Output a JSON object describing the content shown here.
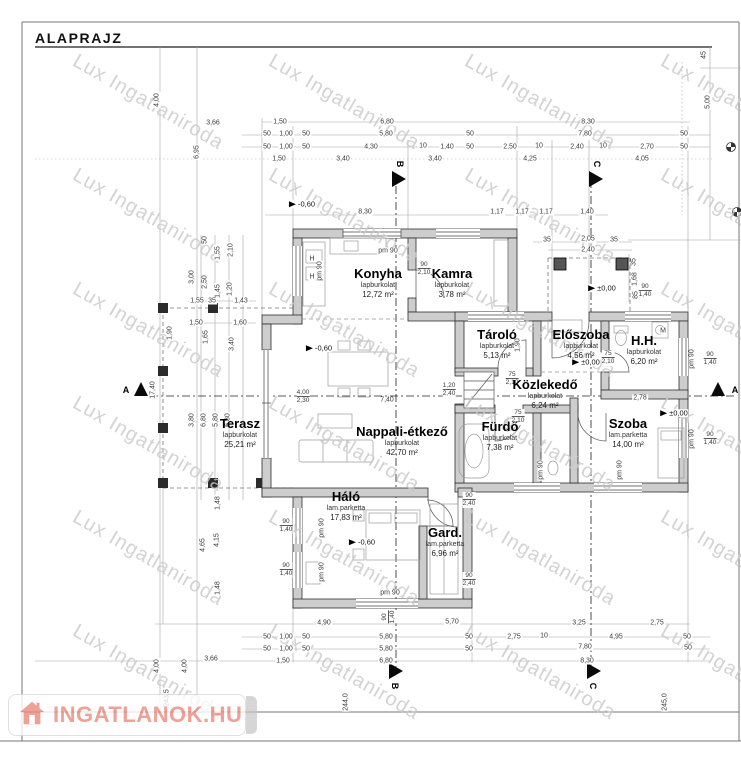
{
  "title": "ALAPRAJZ",
  "watermark": {
    "text": "Lux Ingatlaniroda"
  },
  "logo": {
    "text": "INGATLANOK.HU"
  },
  "colors": {
    "logo_accent": "#ec8a7e",
    "wall_fill": "#cdcdcd",
    "watermark": "#c9c9c9"
  },
  "rooms": [
    {
      "name": "Konyha",
      "floor": "lapburkolat",
      "area": "12,72 m²",
      "x": 378,
      "y": 283
    },
    {
      "name": "Kamra",
      "floor": "lapburkolat",
      "area": "3,78 m²",
      "x": 452,
      "y": 283
    },
    {
      "name": "Tároló",
      "floor": "lapburkolat",
      "area": "5,13 m²",
      "x": 497,
      "y": 344
    },
    {
      "name": "Előszoba",
      "floor": "lapburkolat",
      "area": "4,56 m²",
      "x": 581,
      "y": 344
    },
    {
      "name": "H.H.",
      "floor": "lapburkolat",
      "area": "6,20 m²",
      "x": 644,
      "y": 350
    },
    {
      "name": "Közlekedő",
      "floor": "lapburkolat",
      "area": "6,24 m²",
      "x": 545,
      "y": 394
    },
    {
      "name": "Fürdő",
      "floor": "lapburkolat",
      "area": "7,38 m²",
      "x": 500,
      "y": 436
    },
    {
      "name": "Szoba",
      "floor": "lam.parketta",
      "area": "14,00 m²",
      "x": 628,
      "y": 433
    },
    {
      "name": "Terasz",
      "floor": "lapburkolat",
      "area": "25,21 m²",
      "x": 240,
      "y": 433
    },
    {
      "name": "Nappali-étkező",
      "floor": "lapburkolat",
      "area": "42,70 m²",
      "x": 402,
      "y": 441
    },
    {
      "name": "Háló",
      "floor": "lam.parketta",
      "area": "17,83 m²",
      "x": 346,
      "y": 506
    },
    {
      "name": "Gard.",
      "floor": "lam.parketta",
      "area": "6,96 m²",
      "x": 445,
      "y": 542
    }
  ],
  "levels": [
    {
      "t": "-0,60",
      "x": 302,
      "y": 204
    },
    {
      "t": "-0,60",
      "x": 319,
      "y": 348
    },
    {
      "t": "-0,60",
      "x": 362,
      "y": 542
    },
    {
      "t": "±0,00",
      "x": 602,
      "y": 288
    },
    {
      "t": "±0,00",
      "x": 586,
      "y": 362
    },
    {
      "t": "±0,00",
      "x": 674,
      "y": 413
    }
  ],
  "section_letters": [
    {
      "t": "B",
      "x": 400,
      "y": 164,
      "r": 1
    },
    {
      "t": "C",
      "x": 597,
      "y": 164,
      "r": 1
    },
    {
      "t": "A",
      "x": 126,
      "y": 390
    },
    {
      "t": "A",
      "x": 735,
      "y": 390
    },
    {
      "t": "B",
      "x": 395,
      "y": 686,
      "r": 1
    },
    {
      "t": "C",
      "x": 593,
      "y": 686,
      "r": 1
    }
  ],
  "fractions": [
    {
      "a": "90",
      "b": "2,10",
      "x": 424,
      "y": 269
    },
    {
      "a": "75",
      "b": "2,10",
      "x": 512,
      "y": 379
    },
    {
      "a": "75",
      "b": "2,10",
      "x": 608,
      "y": 358
    },
    {
      "a": "75",
      "b": "2,10",
      "x": 518,
      "y": 417
    },
    {
      "a": "1,20",
      "b": "2,40",
      "x": 449,
      "y": 390
    },
    {
      "a": "4,00",
      "b": "2,30",
      "x": 303,
      "y": 397
    },
    {
      "a": "90",
      "b": "1,40",
      "x": 286,
      "y": 526
    },
    {
      "a": "90",
      "b": "1,40",
      "x": 286,
      "y": 570
    },
    {
      "a": "90",
      "b": "1,40",
      "x": 710,
      "y": 359
    },
    {
      "a": "90",
      "b": "1,40",
      "x": 710,
      "y": 439
    },
    {
      "a": "90",
      "b": "1,40",
      "x": 645,
      "y": 291
    },
    {
      "a": "90",
      "b": "2,40",
      "x": 469,
      "y": 500
    },
    {
      "a": "90",
      "b": "2,40",
      "x": 469,
      "y": 580
    },
    {
      "a": "90",
      "b": "1,40",
      "x": 389,
      "y": 617,
      "r": 1
    }
  ],
  "dims": [
    {
      "t": "1,50",
      "x": 280,
      "y": 122
    },
    {
      "t": "6,80",
      "x": 387,
      "y": 122
    },
    {
      "t": "8,30",
      "x": 588,
      "y": 122
    },
    {
      "t": "50",
      "x": 267,
      "y": 134
    },
    {
      "t": "1,00",
      "x": 286,
      "y": 134
    },
    {
      "t": "50",
      "x": 306,
      "y": 134
    },
    {
      "t": "5,80",
      "x": 386,
      "y": 134
    },
    {
      "t": "50",
      "x": 470,
      "y": 134
    },
    {
      "t": "7,80",
      "x": 585,
      "y": 134
    },
    {
      "t": "50",
      "x": 684,
      "y": 134
    },
    {
      "t": "50",
      "x": 267,
      "y": 147
    },
    {
      "t": "1,00",
      "x": 286,
      "y": 147
    },
    {
      "t": "50",
      "x": 306,
      "y": 147
    },
    {
      "t": "4,30",
      "x": 371,
      "y": 147
    },
    {
      "t": "10",
      "x": 423,
      "y": 146
    },
    {
      "t": "1,40",
      "x": 447,
      "y": 147
    },
    {
      "t": "50",
      "x": 470,
      "y": 147
    },
    {
      "t": "2,50",
      "x": 510,
      "y": 147
    },
    {
      "t": "10",
      "x": 539,
      "y": 146
    },
    {
      "t": "2,40",
      "x": 577,
      "y": 147
    },
    {
      "t": "10",
      "x": 603,
      "y": 146
    },
    {
      "t": "2,70",
      "x": 647,
      "y": 147
    },
    {
      "t": "50",
      "x": 684,
      "y": 147
    },
    {
      "t": "1,50",
      "x": 279,
      "y": 159
    },
    {
      "t": "3,40",
      "x": 343,
      "y": 159
    },
    {
      "t": "3,40",
      "x": 435,
      "y": 159
    },
    {
      "t": "4,25",
      "x": 530,
      "y": 159
    },
    {
      "t": "4,05",
      "x": 642,
      "y": 159
    },
    {
      "t": "3,66",
      "x": 213,
      "y": 123
    },
    {
      "t": "4,00",
      "x": 157,
      "y": 100,
      "r": 1
    },
    {
      "t": "6,95",
      "x": 197,
      "y": 152,
      "r": 1
    },
    {
      "t": "45",
      "x": 704,
      "y": 55,
      "r": 1
    },
    {
      "t": "5,00",
      "x": 708,
      "y": 102,
      "r": 1
    },
    {
      "t": "8,30",
      "x": 365,
      "y": 212
    },
    {
      "t": "1,17",
      "x": 497,
      "y": 212
    },
    {
      "t": "1,17",
      "x": 522,
      "y": 212
    },
    {
      "t": "1,17",
      "x": 546,
      "y": 212
    },
    {
      "t": "1,40",
      "x": 587,
      "y": 212
    },
    {
      "t": "35",
      "x": 547,
      "y": 240
    },
    {
      "t": "2,05",
      "x": 588,
      "y": 239
    },
    {
      "t": "35",
      "x": 614,
      "y": 240
    },
    {
      "t": "2,40",
      "x": 588,
      "y": 250
    },
    {
      "t": "35",
      "x": 634,
      "y": 262,
      "r": 1
    },
    {
      "t": "1,68",
      "x": 635,
      "y": 279,
      "r": 1
    },
    {
      "t": "85",
      "x": 636,
      "y": 295,
      "r": 1
    },
    {
      "t": "50",
      "x": 205,
      "y": 240,
      "r": 1
    },
    {
      "t": "1,55",
      "x": 218,
      "y": 253,
      "r": 1
    },
    {
      "t": "2,10",
      "x": 231,
      "y": 250,
      "r": 1
    },
    {
      "t": "3,00",
      "x": 192,
      "y": 277,
      "r": 1
    },
    {
      "t": "2,50",
      "x": 205,
      "y": 282,
      "r": 1
    },
    {
      "t": "1,45",
      "x": 218,
      "y": 291,
      "r": 1
    },
    {
      "t": "1,20",
      "x": 230,
      "y": 289,
      "r": 1
    },
    {
      "t": "1,55",
      "x": 197,
      "y": 301
    },
    {
      "t": "35",
      "x": 212,
      "y": 301
    },
    {
      "t": "1,43",
      "x": 241,
      "y": 301
    },
    {
      "t": "1,50",
      "x": 196,
      "y": 323
    },
    {
      "t": "1,60",
      "x": 240,
      "y": 323
    },
    {
      "t": "1,90",
      "x": 170,
      "y": 333,
      "r": 1
    },
    {
      "t": "1,65",
      "x": 206,
      "y": 337,
      "r": 1
    },
    {
      "t": "3,40",
      "x": 232,
      "y": 344,
      "r": 1
    },
    {
      "t": "17,40",
      "x": 153,
      "y": 390,
      "r": 1
    },
    {
      "t": "3,80",
      "x": 192,
      "y": 420,
      "r": 1
    },
    {
      "t": "6,80",
      "x": 204,
      "y": 420,
      "r": 1
    },
    {
      "t": "5,80",
      "x": 216,
      "y": 420,
      "r": 1
    },
    {
      "t": "6,30",
      "x": 228,
      "y": 420,
      "r": 1
    },
    {
      "t": "1,48",
      "x": 218,
      "y": 503,
      "r": 1
    },
    {
      "t": "4,65",
      "x": 203,
      "y": 545,
      "r": 1
    },
    {
      "t": "4,15",
      "x": 217,
      "y": 540,
      "r": 1
    },
    {
      "t": "1,48",
      "x": 218,
      "y": 588,
      "r": 1
    },
    {
      "t": "7,40",
      "x": 387,
      "y": 400
    },
    {
      "t": "2,78",
      "x": 640,
      "y": 398
    },
    {
      "t": "1,90",
      "x": 518,
      "y": 345,
      "r": 1
    },
    {
      "t": "M",
      "x": 663,
      "y": 331
    },
    {
      "t": "H",
      "x": 312,
      "y": 259
    },
    {
      "t": "H",
      "x": 312,
      "y": 277
    },
    {
      "t": "pm 90",
      "x": 388,
      "y": 251
    },
    {
      "t": "pm 90",
      "x": 320,
      "y": 271,
      "r": 1
    },
    {
      "t": "pm 90",
      "x": 322,
      "y": 528,
      "r": 1
    },
    {
      "t": "pm 90",
      "x": 322,
      "y": 572,
      "r": 1
    },
    {
      "t": "pm 90",
      "x": 390,
      "y": 593
    },
    {
      "t": "pm 90",
      "x": 692,
      "y": 359,
      "r": 1
    },
    {
      "t": "pm 90",
      "x": 692,
      "y": 439,
      "r": 1
    },
    {
      "t": "pm 90",
      "x": 541,
      "y": 470,
      "r": 1
    },
    {
      "t": "pm 90",
      "x": 620,
      "y": 470,
      "r": 1
    },
    {
      "t": "4,90",
      "x": 324,
      "y": 623
    },
    {
      "t": "5,70",
      "x": 452,
      "y": 622
    },
    {
      "t": "3,25",
      "x": 579,
      "y": 623
    },
    {
      "t": "2,75",
      "x": 657,
      "y": 623
    },
    {
      "t": "50",
      "x": 267,
      "y": 637
    },
    {
      "t": "1,00",
      "x": 286,
      "y": 637
    },
    {
      "t": "50",
      "x": 306,
      "y": 637
    },
    {
      "t": "5,80",
      "x": 386,
      "y": 637
    },
    {
      "t": "50",
      "x": 469,
      "y": 637
    },
    {
      "t": "2,75",
      "x": 514,
      "y": 637
    },
    {
      "t": "10",
      "x": 544,
      "y": 636
    },
    {
      "t": "4,95",
      "x": 616,
      "y": 637
    },
    {
      "t": "50",
      "x": 687,
      "y": 637
    },
    {
      "t": "50",
      "x": 267,
      "y": 649
    },
    {
      "t": "1,00",
      "x": 286,
      "y": 649
    },
    {
      "t": "50",
      "x": 306,
      "y": 649
    },
    {
      "t": "5,80",
      "x": 386,
      "y": 649
    },
    {
      "t": "50",
      "x": 469,
      "y": 649
    },
    {
      "t": "7,80",
      "x": 585,
      "y": 647
    },
    {
      "t": "50",
      "x": 688,
      "y": 648
    },
    {
      "t": "1,50",
      "x": 283,
      "y": 661
    },
    {
      "t": "6,80",
      "x": 386,
      "y": 661
    },
    {
      "t": "8,30",
      "x": 587,
      "y": 661
    },
    {
      "t": "3,66",
      "x": 211,
      "y": 659
    },
    {
      "t": "4,00",
      "x": 157,
      "y": 666,
      "r": 1
    },
    {
      "t": "4,00",
      "x": 185,
      "y": 666,
      "r": 1
    },
    {
      "t": "243,5",
      "x": 167,
      "y": 698,
      "r": 1
    },
    {
      "t": "244,0",
      "x": 346,
      "y": 702,
      "r": 1
    },
    {
      "t": "245,0",
      "x": 665,
      "y": 702,
      "r": 1
    }
  ]
}
